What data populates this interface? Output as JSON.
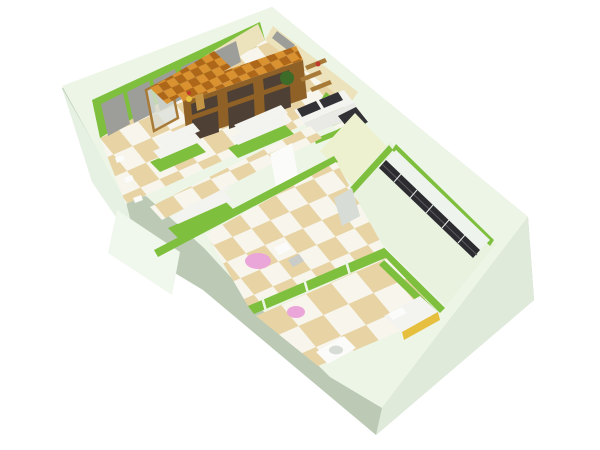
{
  "scene": {
    "type": "3d-floor-plan-render",
    "view": "isometric-perspective",
    "rooms": [
      {
        "name": "showroom",
        "features": [
          "window-wall",
          "display-cabinet",
          "canopy",
          "sofa",
          "shelf-units"
        ]
      },
      {
        "name": "hallway",
        "features": [
          "checker-floor",
          "white-wardrobe"
        ]
      },
      {
        "name": "closet",
        "features": [
          "empty-floor"
        ]
      },
      {
        "name": "wardrobe-room",
        "features": [
          "dark-locker-row"
        ]
      },
      {
        "name": "play-room",
        "features": [
          "pink-round-table",
          "chairs",
          "glass-partition"
        ]
      },
      {
        "name": "bath-room",
        "features": [
          "pink-stool",
          "bed",
          "sink"
        ]
      }
    ]
  },
  "colors": {
    "bg": "#ffffff",
    "wallTop": "#edf6e6",
    "faceShadow": "#bccab5",
    "faceBright": "#dfeada",
    "faceSW": "#e7f1e3",
    "notchFace": "#f0f7ec",
    "green": "#7fbf3e",
    "greenDeep": "#69a82f",
    "tileBeige": "#e7d3a3",
    "tileWhite": "#f7f5ec",
    "closetFloor": "#eef1cf",
    "rightFloor": "#e9f2df",
    "lockerDark": "#2c2c30",
    "lockerTop": "#eff3ee",
    "lockerLine": "#e8e8e8",
    "lockerMid": "#5a5a60",
    "wood": "#8f6126",
    "woodLight": "#c49544",
    "woodMid": "#a87a38",
    "canopyOrange": "#d9922f",
    "canopyOrangeDark": "#ae6718",
    "glassGray": "#9d9e9a",
    "glassDark": "#4e4034",
    "tanWall": "#ece3bd",
    "sofaWhite": "#f3f3f0",
    "sofaSeat": "#e9e9e5",
    "cushionDark": "#323236",
    "pink": "#eba6d9",
    "bedYellow": "#e7bf3e",
    "pureWhite": "#fbfcfa",
    "frostBlob": "#d7dcd6",
    "plantGreen": "#3d6b28",
    "chairGray": "#c9ccc9",
    "accentRed": "#c0392b",
    "caseGlass": "#d9dfd9"
  }
}
